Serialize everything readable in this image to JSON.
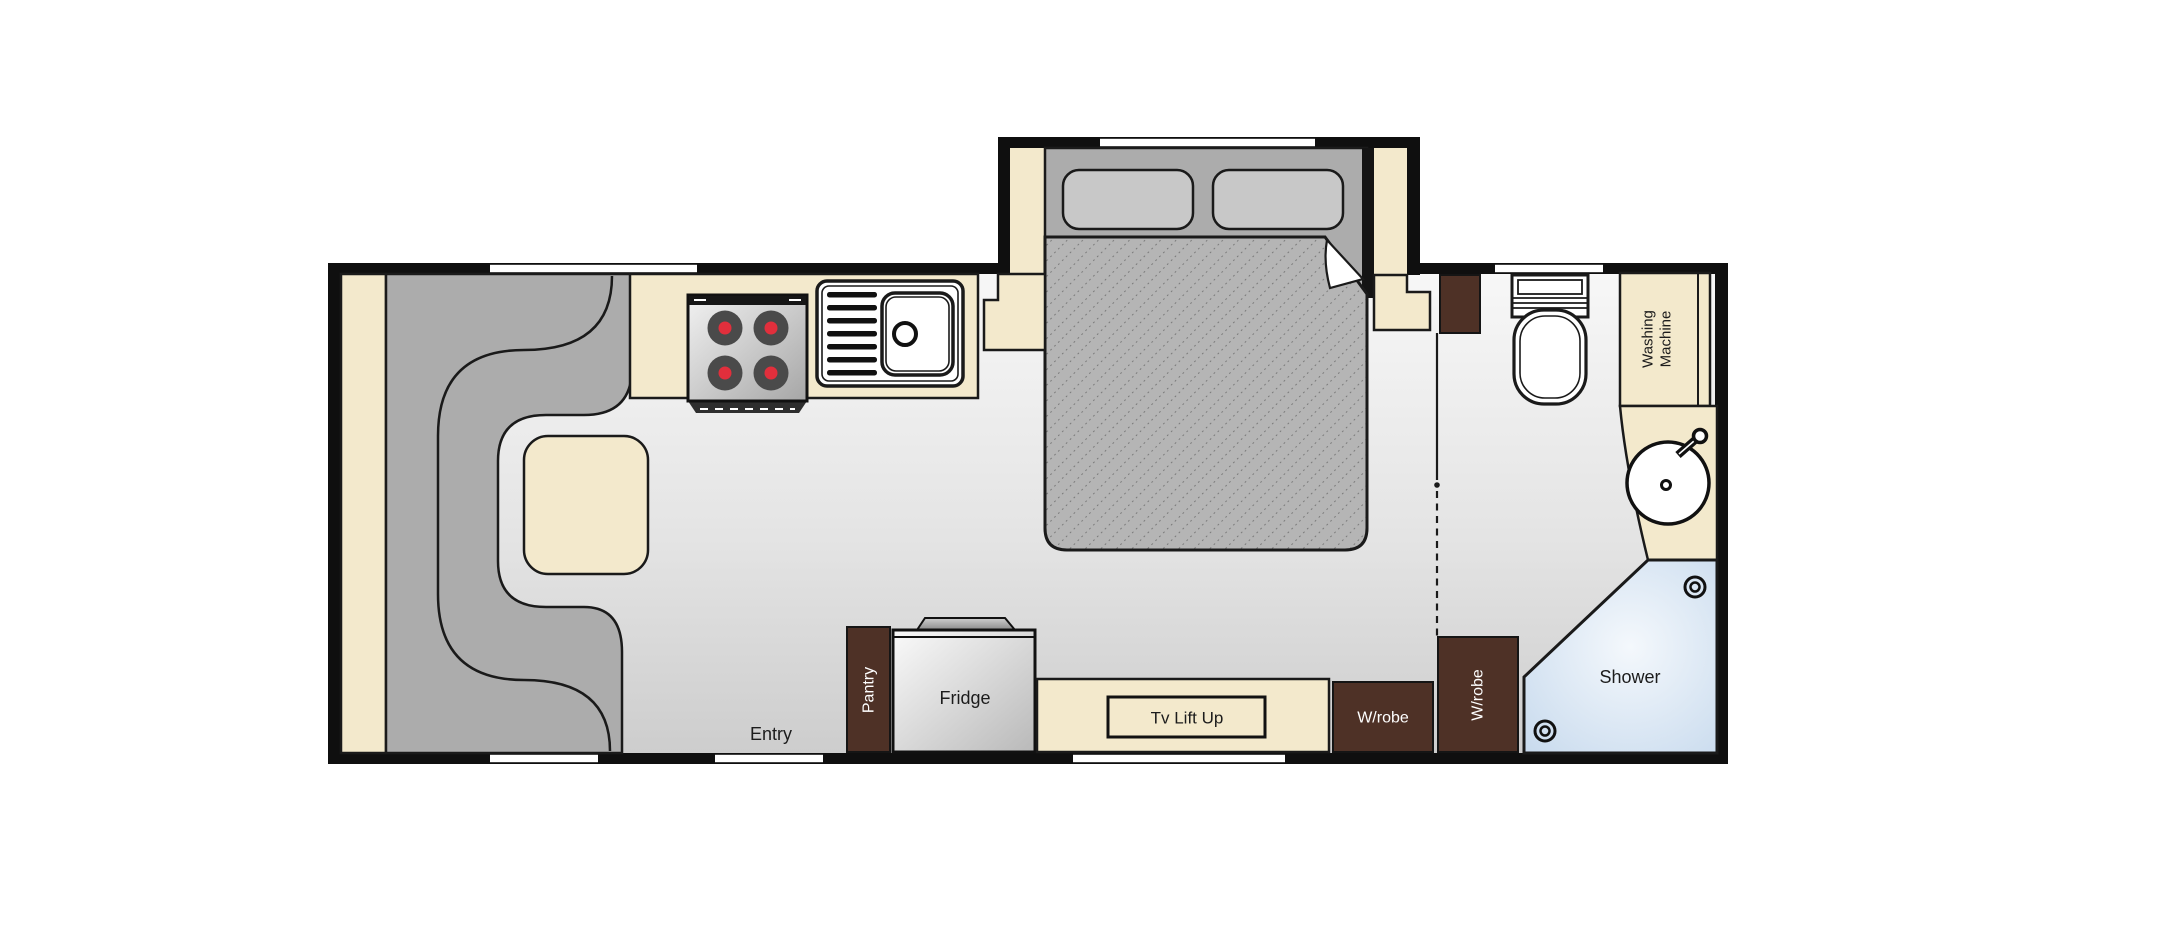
{
  "floorplan": {
    "title": "Caravan floor plan",
    "labels": {
      "entry": "Entry",
      "pantry": "Pantry",
      "fridge": "Fridge",
      "tv_lift_up": "Tv Lift Up",
      "wardrobe_rear": "W/robe",
      "wardrobe_side": "W/robe",
      "washing_machine_line1": "Washing",
      "washing_machine_line2": "Machine",
      "shower": "Shower"
    },
    "colors": {
      "wall": "#0f0f0f",
      "outline": "#1a1a1a",
      "cream": "#F3E9CC",
      "furniture_gray": "#ACACAC",
      "pillow_gray": "#C8C8C8",
      "mattress_gray": "#B5B5B5",
      "mattress_hatch": "#707070",
      "brown": "#4E3126",
      "shower_blue": "#C9DBEE",
      "floor_light": "#F6F6F6",
      "floor_dark": "#CDCDCD",
      "burner_red": "#E12F3C",
      "label_text": "#1c1c1c",
      "label_text_light": "#ffffff"
    }
  }
}
